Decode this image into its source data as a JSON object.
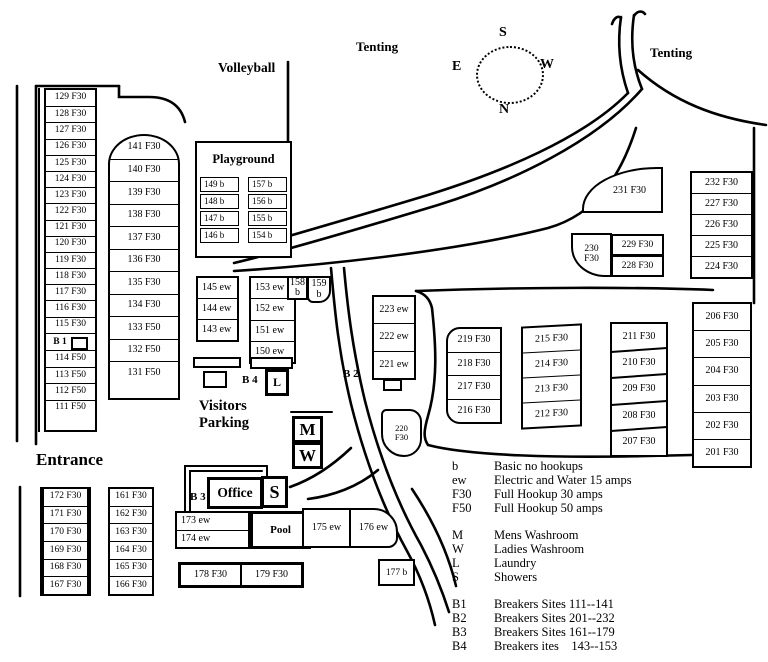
{
  "areas": {
    "volleyball": "Volleyball",
    "tenting_west": "Tenting",
    "tenting_east": "Tenting",
    "playground": "Playground",
    "visitors_parking": "Visitors\nParking",
    "entrance": "Entrance",
    "office": "Office",
    "pool": "Pool"
  },
  "compass": {
    "top": "S",
    "bottom": "N",
    "left": "E",
    "right": "W"
  },
  "markers": {
    "b1": "B 1",
    "b2": "B 2",
    "b3": "B 3",
    "b4": "B 4",
    "mens_washroom": "M",
    "ladies_washroom": "W",
    "showers": "S",
    "laundry": "L"
  },
  "sites": {
    "west_upper": [
      "129 F30",
      "128 F30",
      "127 F30",
      "126 F30",
      "125 F30",
      "124 F30",
      "123 F30",
      "122 F30",
      "121 F30",
      "120 F30",
      "119 F30",
      "118 F30",
      "117 F30",
      "116 F30",
      "115 F30"
    ],
    "west_lower": [
      "114 F50",
      "113 F50",
      "112 F50",
      "111 F50"
    ],
    "inner_west": [
      "141 F30",
      "140 F30",
      "139 F30",
      "138 F30",
      "137 F30",
      "136 F30",
      "135 F30",
      "134 F30",
      "133 F50",
      "132 F50",
      "131 F50"
    ],
    "playground_west": [
      "149 b",
      "148 b",
      "147 b",
      "146 b"
    ],
    "playground_east": [
      "157 b",
      "156 b",
      "155 b",
      "154 b"
    ],
    "ew_143": [
      "145 ew",
      "144 ew",
      "143 ew"
    ],
    "ew_150": [
      "153 ew",
      "152 ew",
      "151 ew",
      "150 ew"
    ],
    "b_158": "158\nb",
    "b_159": "159\nb",
    "ew_221": [
      "223 ew",
      "222 ew",
      "221 ew"
    ],
    "f_216": [
      "219 F30",
      "218 F30",
      "217 F30",
      "216 F30"
    ],
    "f_212": [
      "215 F30",
      "214 F30",
      "213 F30",
      "212 F30"
    ],
    "f_207": [
      "211 F30",
      "210 F30",
      "209 F30",
      "208 F30",
      "207 F30"
    ],
    "f_201": [
      "206 F30",
      "205 F30",
      "204 F30",
      "203 F30",
      "202 F30",
      "201 F30"
    ],
    "f_224": [
      "232 F30",
      "227 F30",
      "226 F30",
      "225 F30",
      "224 F30"
    ],
    "site_231": "231 F30",
    "site_230": "230\nF30",
    "site_229": "229 F30",
    "site_228": "228 F30",
    "site_220": "220\nF30",
    "entrance_west": [
      "172 F30",
      "171 F30",
      "170 F30",
      "169 F30",
      "168 F30",
      "167 F30"
    ],
    "entrance_east": [
      "161 F30",
      "162 F30",
      "163 F30",
      "164 F30",
      "165 F30",
      "166 F30"
    ],
    "ew_174": [
      "173 ew",
      "174 ew"
    ],
    "ew_176": [
      "175 ew",
      "176 ew"
    ],
    "site_177": "177 b",
    "f_178": [
      "178 F30",
      "179 F30"
    ]
  },
  "legend": {
    "hookups": [
      {
        "key": "b",
        "desc": "Basic no hookups"
      },
      {
        "key": "ew",
        "desc": "Electric and Water 15 amps"
      },
      {
        "key": "F30",
        "desc": "Full Hookup 30 amps"
      },
      {
        "key": "F50",
        "desc": "Full Hookup 50 amps"
      }
    ],
    "facilities": [
      {
        "key": "M",
        "desc": "Mens Washroom"
      },
      {
        "key": "W",
        "desc": "Ladies Washroom"
      },
      {
        "key": "L",
        "desc": "Laundry"
      },
      {
        "key": "S",
        "desc": "Showers"
      }
    ],
    "breakers": [
      {
        "key": "B1",
        "desc": "Breakers Sites 111--141"
      },
      {
        "key": "B2",
        "desc": "Breakers Sites 201--232"
      },
      {
        "key": "B3",
        "desc": "Breakers Sites 161--179"
      },
      {
        "key": "B4",
        "desc": "Breakers ites    143--153"
      }
    ]
  }
}
